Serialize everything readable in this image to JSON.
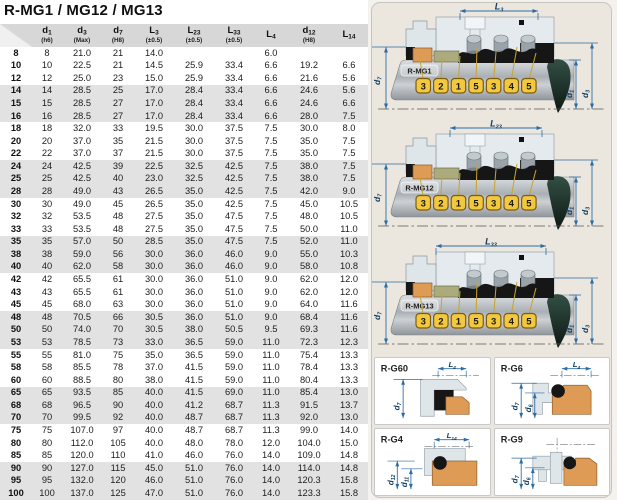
{
  "title": "R-MG1 / MG12 / MG13",
  "table": {
    "col_widths": [
      32,
      30,
      40,
      32,
      40,
      40,
      40,
      34,
      42,
      38
    ],
    "columns": [
      {
        "base": "",
        "sub": "",
        "tol": ""
      },
      {
        "base": "d",
        "sub": "1",
        "tol": "(h6)"
      },
      {
        "base": "d",
        "sub": "3",
        "tol": "(Max)"
      },
      {
        "base": "d",
        "sub": "7",
        "tol": "(H8)"
      },
      {
        "base": "L",
        "sub": "3",
        "tol": "(±0.5)"
      },
      {
        "base": "L",
        "sub": "23",
        "tol": "(±0.5)"
      },
      {
        "base": "L",
        "sub": "33",
        "tol": "(±0.5)"
      },
      {
        "base": "L",
        "sub": "4",
        "tol": ""
      },
      {
        "base": "d",
        "sub": "12",
        "tol": "(H8)"
      },
      {
        "base": "L",
        "sub": "14",
        "tol": ""
      }
    ],
    "stripe_group_size": 3,
    "rows": [
      [
        "8",
        "8",
        "21.0",
        "21",
        "14.0",
        "",
        "",
        "6.0",
        "",
        ""
      ],
      [
        "10",
        "10",
        "22.5",
        "21",
        "14.5",
        "25.9",
        "33.4",
        "6.6",
        "19.2",
        "6.6"
      ],
      [
        "12",
        "12",
        "25.0",
        "23",
        "15.0",
        "25.9",
        "33.4",
        "6.6",
        "21.6",
        "5.6"
      ],
      [
        "14",
        "14",
        "28.5",
        "25",
        "17.0",
        "28.4",
        "33.4",
        "6.6",
        "24.6",
        "5.6"
      ],
      [
        "15",
        "15",
        "28.5",
        "27",
        "17.0",
        "28.4",
        "33.4",
        "6.6",
        "24.6",
        "6.6"
      ],
      [
        "16",
        "16",
        "28.5",
        "27",
        "17.0",
        "28.4",
        "33.4",
        "6.6",
        "28.0",
        "7.5"
      ],
      [
        "18",
        "18",
        "32.0",
        "33",
        "19.5",
        "30.0",
        "37.5",
        "7.5",
        "30.0",
        "8.0"
      ],
      [
        "20",
        "20",
        "37.0",
        "35",
        "21.5",
        "30.0",
        "37.5",
        "7.5",
        "35.0",
        "7.5"
      ],
      [
        "22",
        "22",
        "37.0",
        "37",
        "21.5",
        "30.0",
        "37.5",
        "7.5",
        "35.0",
        "7.5"
      ],
      [
        "24",
        "24",
        "42.5",
        "39",
        "22.5",
        "32.5",
        "42.5",
        "7.5",
        "38.0",
        "7.5"
      ],
      [
        "25",
        "25",
        "42.5",
        "40",
        "23.0",
        "32.5",
        "42.5",
        "7.5",
        "38.0",
        "7.5"
      ],
      [
        "28",
        "28",
        "49.0",
        "43",
        "26.5",
        "35.0",
        "42.5",
        "7.5",
        "42.0",
        "9.0"
      ],
      [
        "30",
        "30",
        "49.0",
        "45",
        "26.5",
        "35.0",
        "42.5",
        "7.5",
        "45.0",
        "10.5"
      ],
      [
        "32",
        "32",
        "53.5",
        "48",
        "27.5",
        "35.0",
        "47.5",
        "7.5",
        "48.0",
        "10.5"
      ],
      [
        "33",
        "33",
        "53.5",
        "48",
        "27.5",
        "35.0",
        "47.5",
        "7.5",
        "50.0",
        "11.0"
      ],
      [
        "35",
        "35",
        "57.0",
        "50",
        "28.5",
        "35.0",
        "47.5",
        "7.5",
        "52.0",
        "11.0"
      ],
      [
        "38",
        "38",
        "59.0",
        "56",
        "30.0",
        "36.0",
        "46.0",
        "9.0",
        "55.0",
        "10.3"
      ],
      [
        "40",
        "40",
        "62.0",
        "58",
        "30.0",
        "36.0",
        "46.0",
        "9.0",
        "58.0",
        "10.8"
      ],
      [
        "42",
        "42",
        "65.5",
        "61",
        "30.0",
        "36.0",
        "51.0",
        "9.0",
        "62.0",
        "12.0"
      ],
      [
        "43",
        "43",
        "65.5",
        "61",
        "30.0",
        "36.0",
        "51.0",
        "9.0",
        "62.0",
        "12.0"
      ],
      [
        "45",
        "45",
        "68.0",
        "63",
        "30.0",
        "36.0",
        "51.0",
        "9.0",
        "64.0",
        "11.6"
      ],
      [
        "48",
        "48",
        "70.5",
        "66",
        "30.5",
        "36.0",
        "51.0",
        "9.0",
        "68.4",
        "11.6"
      ],
      [
        "50",
        "50",
        "74.0",
        "70",
        "30.5",
        "38.0",
        "50.5",
        "9.5",
        "69.3",
        "11.6"
      ],
      [
        "53",
        "53",
        "78.5",
        "73",
        "33.0",
        "36.5",
        "59.0",
        "11.0",
        "72.3",
        "12.3"
      ],
      [
        "55",
        "55",
        "81.0",
        "75",
        "35.0",
        "36.5",
        "59.0",
        "11.0",
        "75.4",
        "13.3"
      ],
      [
        "58",
        "58",
        "85.5",
        "78",
        "37.0",
        "41.5",
        "59.0",
        "11.0",
        "78.4",
        "13.3"
      ],
      [
        "60",
        "60",
        "88.5",
        "80",
        "38.0",
        "41.5",
        "59.0",
        "11.0",
        "80.4",
        "13.3"
      ],
      [
        "65",
        "65",
        "93.5",
        "85",
        "40.0",
        "41.5",
        "69.0",
        "11.0",
        "85.4",
        "13.0"
      ],
      [
        "68",
        "68",
        "96.5",
        "90",
        "40.0",
        "41.2",
        "68.7",
        "11.3",
        "91.5",
        "13.7"
      ],
      [
        "70",
        "70",
        "99.5",
        "92",
        "40.0",
        "48.7",
        "68.7",
        "11.3",
        "92.0",
        "13.0"
      ],
      [
        "75",
        "75",
        "107.0",
        "97",
        "40.0",
        "48.7",
        "68.7",
        "11.3",
        "99.0",
        "14.0"
      ],
      [
        "80",
        "80",
        "112.0",
        "105",
        "40.0",
        "48.0",
        "78.0",
        "12.0",
        "104.0",
        "15.0"
      ],
      [
        "85",
        "85",
        "120.0",
        "110",
        "41.0",
        "46.0",
        "76.0",
        "14.0",
        "109.0",
        "14.8"
      ],
      [
        "90",
        "90",
        "127.0",
        "115",
        "45.0",
        "51.0",
        "76.0",
        "14.0",
        "114.0",
        "14.8"
      ],
      [
        "95",
        "95",
        "132.0",
        "120",
        "46.0",
        "51.0",
        "76.0",
        "14.0",
        "120.3",
        "15.8"
      ],
      [
        "100",
        "100",
        "137.0",
        "125",
        "47.0",
        "51.0",
        "76.0",
        "14.0",
        "123.3",
        "15.8"
      ]
    ]
  },
  "seal_diagrams": [
    {
      "label": "R-MG1",
      "dim_top": "L3",
      "dim_left": "d7",
      "dim_inner": "d1",
      "dim_outer": "d3",
      "callouts": [
        "3",
        "2",
        "1",
        "5",
        "3",
        "4",
        "5"
      ],
      "span": [
        90,
        168
      ]
    },
    {
      "label": "R-MG12",
      "dim_top": "L23",
      "dim_left": "d7",
      "dim_inner": "d1",
      "dim_outer": "d3",
      "callouts": [
        "3",
        "2",
        "1",
        "5",
        "3",
        "4",
        "5"
      ],
      "span": [
        80,
        172
      ]
    },
    {
      "label": "R-MG13",
      "dim_top": "L33",
      "dim_left": "d7",
      "dim_inner": "d1",
      "dim_outer": "d3",
      "callouts": [
        "3",
        "2",
        "1",
        "5",
        "3",
        "4",
        "5"
      ],
      "span": [
        66,
        176
      ]
    }
  ],
  "detail_diagrams": [
    {
      "label": "R-G60",
      "dim_top": "L4",
      "dims_left": [
        "d7"
      ],
      "variant": "g60"
    },
    {
      "label": "R-G6",
      "dim_top": "L4",
      "dims_left": [
        "d7",
        "d6"
      ],
      "variant": "g6"
    },
    {
      "label": "R-G4",
      "dim_top": "L14",
      "dims_left": [
        "d12",
        "d11"
      ],
      "variant": "g4"
    },
    {
      "label": "R-G9",
      "dim_top": "",
      "dims_left": [
        "d7",
        "d6"
      ],
      "variant": "g9"
    }
  ],
  "colors": {
    "dim_line": "#2e6da4",
    "dim_text": "#123f63",
    "callout_yellow": "#f2c83e",
    "callout_border": "#7d5c12",
    "leader": "#c9a42e",
    "orange": "#de9b55",
    "olive": "#abab7e",
    "metal": "#dfe6ea",
    "black_rubber": "#161616",
    "teal_dark": "#1f332c",
    "header_bg": "#d7d7d7",
    "stripe_bg": "#e2e2e2",
    "panel_bg": "#ece7de"
  }
}
